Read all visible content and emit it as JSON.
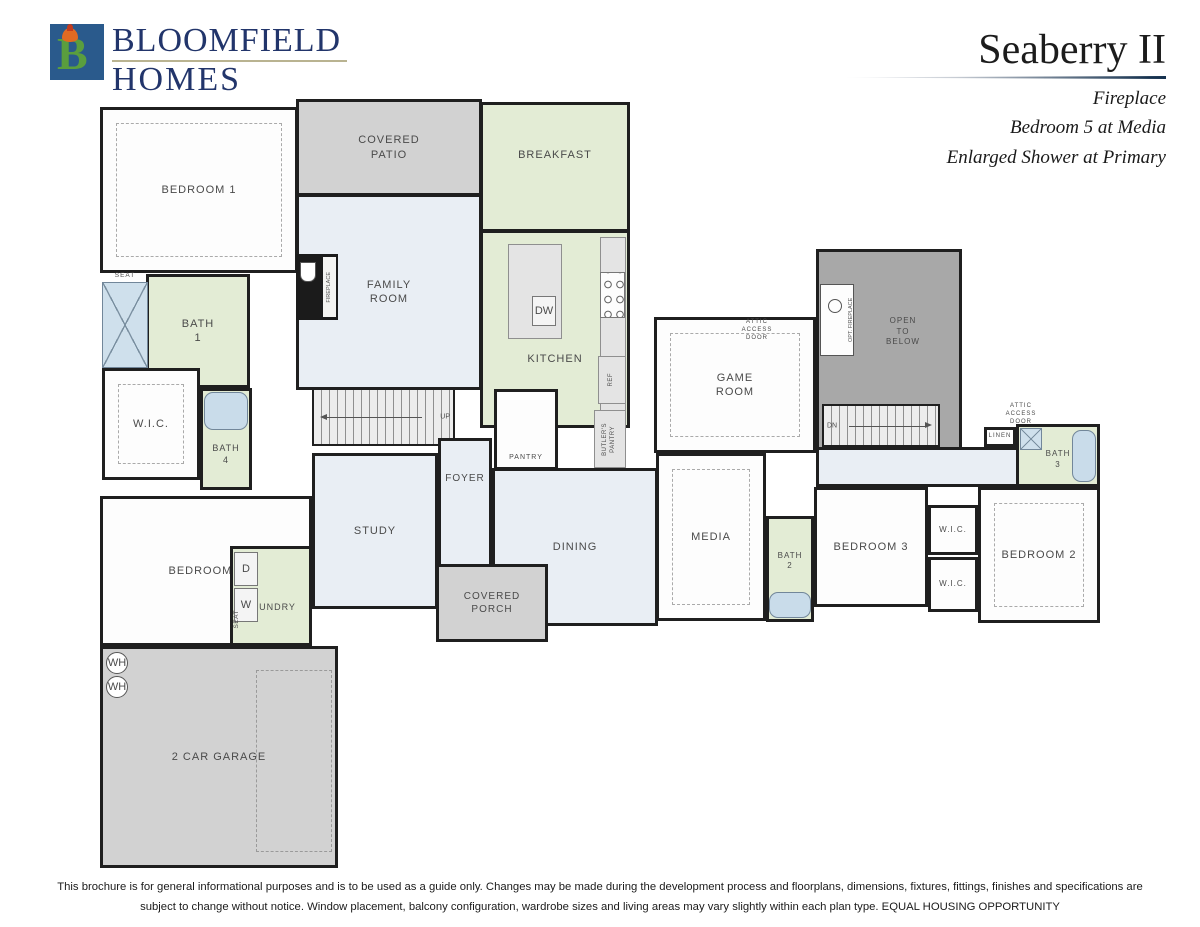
{
  "header": {
    "logo": {
      "monogram": "B",
      "line1": "BLOOMFIELD",
      "line2": "HOMES"
    },
    "plan_name": "Seaberry II",
    "options": [
      "Fireplace",
      "Bedroom 5 at Media",
      "Enlarged Shower at Primary"
    ]
  },
  "footer": {
    "line1": "This brochure is for general informational purposes and is to be used as a guide only. Changes may be made during the development process and floorplans, dimensions, fixtures, fittings, finishes and specifications are",
    "line2": "subject to change without notice. Window placement, balcony configuration, wardrobe sizes and living areas may vary slightly within each plan type.  EQUAL HOUSING OPPORTUNITY"
  },
  "colors": {
    "white": "#fdfdfd",
    "green": "#e3ecd5",
    "blue": "#e9eef4",
    "patio": "#d2d2d2",
    "garage": "#d2d2d2",
    "open": "#a8a8a8",
    "counter": "#e4e4e4",
    "wall": "#1f1f1f",
    "logo_blue": "#2a5a8c",
    "logo_green": "#5a9e3e",
    "logo_navy": "#22356b",
    "tub_blue": "#c9dcea"
  },
  "floor_plans": [
    {
      "name": "first-floor",
      "elements": [
        {
          "type": "room",
          "name": "bedroom-1",
          "label": "BEDROOM 1",
          "x": 100,
          "y": 107,
          "w": 198,
          "h": 166,
          "fill": "white",
          "dashedInner": true
        },
        {
          "type": "room",
          "name": "covered-patio",
          "label": "COVERED\nPATIO",
          "x": 296,
          "y": 99,
          "w": 186,
          "h": 97,
          "fill": "patio"
        },
        {
          "type": "room",
          "name": "breakfast",
          "label": "BREAKFAST",
          "x": 480,
          "y": 102,
          "w": 150,
          "h": 130,
          "fill": "green",
          "labelDy": -12
        },
        {
          "type": "room",
          "name": "family-room",
          "label": "FAMILY\nROOM",
          "x": 296,
          "y": 194,
          "w": 186,
          "h": 196,
          "fill": "blue"
        },
        {
          "type": "room",
          "name": "kitchen",
          "label": "KITCHEN",
          "x": 480,
          "y": 230,
          "w": 150,
          "h": 198,
          "fill": "green",
          "labelDy": 30
        },
        {
          "type": "counter",
          "name": "kitchen-counter",
          "x": 600,
          "y": 237,
          "w": 26,
          "h": 188
        },
        {
          "type": "cooktop",
          "name": "cooktop",
          "x": 600,
          "y": 272,
          "w": 25,
          "h": 46
        },
        {
          "type": "counter",
          "name": "kitchen-island",
          "x": 508,
          "y": 244,
          "w": 54,
          "h": 95
        },
        {
          "type": "appliance",
          "name": "dishwasher",
          "label": "DW",
          "x": 532,
          "y": 296,
          "w": 24,
          "h": 30
        },
        {
          "type": "fireplace",
          "name": "fireplace",
          "label": "FIREPLACE",
          "x": 296,
          "y": 254,
          "w": 42,
          "h": 66
        },
        {
          "type": "room",
          "name": "bath-1",
          "label": "BATH\n1",
          "x": 146,
          "y": 274,
          "w": 104,
          "h": 114,
          "fill": "green"
        },
        {
          "type": "fixture-shower",
          "name": "shower-bath-1",
          "x": 102,
          "y": 282,
          "w": 46,
          "h": 86
        },
        {
          "type": "label",
          "name": "seat-label-bath-1",
          "label": "SEAT",
          "x": 102,
          "y": 271,
          "w": 46,
          "h": 10,
          "fontSize": 6.5
        },
        {
          "type": "room",
          "name": "wic-primary",
          "label": "W.I.C.",
          "x": 102,
          "y": 368,
          "w": 98,
          "h": 112,
          "fill": "white",
          "dashedInner": true
        },
        {
          "type": "room",
          "name": "bath-4",
          "label": "BATH\n4",
          "x": 200,
          "y": 388,
          "w": 52,
          "h": 102,
          "fill": "green",
          "labelDy": 16,
          "fontSize": 9
        },
        {
          "type": "fixture-tub",
          "name": "tub-bath-4",
          "x": 204,
          "y": 392,
          "w": 44,
          "h": 38
        },
        {
          "type": "room",
          "name": "bedroom-5",
          "label": "BEDROOM 5",
          "x": 100,
          "y": 496,
          "w": 212,
          "h": 150,
          "fill": "white"
        },
        {
          "type": "room",
          "name": "laundry",
          "label": "LAUNDRY",
          "x": 230,
          "y": 546,
          "w": 82,
          "h": 100,
          "fill": "green",
          "labelDy": 12,
          "fontSize": 9
        },
        {
          "type": "appliance",
          "name": "dryer",
          "label": "D",
          "x": 234,
          "y": 552,
          "w": 24,
          "h": 34
        },
        {
          "type": "appliance",
          "name": "washer",
          "label": "W",
          "x": 234,
          "y": 588,
          "w": 24,
          "h": 34
        },
        {
          "type": "label",
          "name": "seat-label-laundry",
          "label": "SEAT",
          "x": 230,
          "y": 598,
          "w": 14,
          "h": 42,
          "fontSize": 6.5,
          "vertical": true
        },
        {
          "type": "stairs",
          "name": "stairs-up",
          "label": "UP",
          "x": 312,
          "y": 388,
          "w": 143,
          "h": 58,
          "dir": "left"
        },
        {
          "type": "room",
          "name": "study",
          "label": "STUDY",
          "x": 312,
          "y": 453,
          "w": 126,
          "h": 156,
          "fill": "blue"
        },
        {
          "type": "room",
          "name": "foyer",
          "label": "FOYER",
          "x": 438,
          "y": 438,
          "w": 54,
          "h": 152,
          "fill": "blue",
          "fontSize": 10,
          "labelDy": -36
        },
        {
          "type": "room",
          "name": "pantry",
          "label": "PANTRY",
          "x": 494,
          "y": 389,
          "w": 64,
          "h": 81,
          "fill": "white",
          "fontSize": 7,
          "labelDy": 28
        },
        {
          "type": "counter",
          "name": "ref-counter",
          "x": 598,
          "y": 356,
          "w": 28,
          "h": 48
        },
        {
          "type": "label",
          "name": "ref-label",
          "label": "REF",
          "x": 600,
          "y": 358,
          "w": 24,
          "h": 44,
          "fontSize": 6,
          "vertical": true
        },
        {
          "type": "counter",
          "name": "butlers-pantry-counter",
          "x": 594,
          "y": 410,
          "w": 32,
          "h": 58
        },
        {
          "type": "label",
          "name": "butlers-pantry-label",
          "label": "BUTLER'S\nPANTRY",
          "x": 596,
          "y": 412,
          "w": 28,
          "h": 54,
          "fontSize": 6,
          "vertical": true
        },
        {
          "type": "room",
          "name": "dining",
          "label": "DINING",
          "x": 492,
          "y": 468,
          "w": 166,
          "h": 158,
          "fill": "blue"
        },
        {
          "type": "room",
          "name": "covered-porch",
          "label": "COVERED\nPORCH",
          "x": 436,
          "y": 564,
          "w": 112,
          "h": 78,
          "fill": "patio",
          "fontSize": 10
        },
        {
          "type": "room",
          "name": "garage",
          "label": "2 CAR GARAGE",
          "x": 100,
          "y": 646,
          "w": 238,
          "h": 222,
          "fill": "garage"
        },
        {
          "type": "dashed",
          "name": "garage-bay-outline",
          "x": 256,
          "y": 670,
          "w": 76,
          "h": 182
        },
        {
          "type": "circle",
          "name": "water-heater-1",
          "label": "WH",
          "x": 106,
          "y": 652,
          "w": 22,
          "h": 22
        },
        {
          "type": "circle",
          "name": "water-heater-2",
          "label": "WH",
          "x": 106,
          "y": 676,
          "w": 22,
          "h": 22
        }
      ]
    },
    {
      "name": "second-floor",
      "elements": [
        {
          "type": "room",
          "name": "open-to-below",
          "label": "OPEN\nTO\nBELOW",
          "x": 816,
          "y": 249,
          "w": 146,
          "h": 206,
          "fill": "open",
          "fontSize": 8,
          "labelDy": -20,
          "labelDx": 14
        },
        {
          "type": "fireplace2",
          "name": "optional-fireplace",
          "label": "OPT. FIREPLACE",
          "x": 820,
          "y": 284,
          "w": 34,
          "h": 72
        },
        {
          "type": "room",
          "name": "game-room",
          "label": "GAME\nROOM",
          "x": 654,
          "y": 317,
          "w": 162,
          "h": 136,
          "fill": "white",
          "dashedInner": true
        },
        {
          "type": "label",
          "name": "attic-access-door-label-1",
          "label": "ATTIC\nACCESS\nDOOR",
          "x": 734,
          "y": 318,
          "w": 46,
          "h": 26,
          "fontSize": 6
        },
        {
          "type": "stairs",
          "name": "stairs-down",
          "label": "DN",
          "x": 822,
          "y": 404,
          "w": 118,
          "h": 43,
          "dir": "right"
        },
        {
          "type": "room",
          "name": "upstairs-hall",
          "label": "",
          "x": 816,
          "y": 447,
          "w": 216,
          "h": 40,
          "fill": "blue"
        },
        {
          "type": "label",
          "name": "attic-access-door-label-2",
          "label": "ATTIC\nACCESS\nDOOR",
          "x": 1000,
          "y": 402,
          "w": 42,
          "h": 26,
          "fontSize": 6
        },
        {
          "type": "room",
          "name": "linen",
          "label": "LINEN",
          "x": 984,
          "y": 427,
          "w": 32,
          "h": 20,
          "fill": "white",
          "fontSize": 6
        },
        {
          "type": "room",
          "name": "bath-3",
          "label": "BATH\n3",
          "x": 1016,
          "y": 424,
          "w": 84,
          "h": 63,
          "fill": "green",
          "fontSize": 8,
          "labelDy": 4
        },
        {
          "type": "fixture-shower",
          "name": "shower-bath-3",
          "x": 1020,
          "y": 428,
          "w": 22,
          "h": 22
        },
        {
          "type": "fixture-tub-v",
          "name": "tub-bath-3",
          "x": 1072,
          "y": 430,
          "w": 24,
          "h": 52
        },
        {
          "type": "room",
          "name": "media",
          "label": "MEDIA",
          "x": 656,
          "y": 453,
          "w": 110,
          "h": 168,
          "fill": "white",
          "dashedInner": true
        },
        {
          "type": "room",
          "name": "bath-2",
          "label": "BATH\n2",
          "x": 766,
          "y": 516,
          "w": 48,
          "h": 106,
          "fill": "green",
          "fontSize": 8,
          "labelDy": -8
        },
        {
          "type": "fixture-tub",
          "name": "tub-bath-2",
          "x": 769,
          "y": 592,
          "w": 42,
          "h": 26
        },
        {
          "type": "room",
          "name": "bedroom-3",
          "label": "BEDROOM 3",
          "x": 814,
          "y": 487,
          "w": 114,
          "h": 120,
          "fill": "white"
        },
        {
          "type": "room",
          "name": "wic-bedroom-3",
          "label": "W.I.C.",
          "x": 928,
          "y": 505,
          "w": 50,
          "h": 50,
          "fill": "white",
          "fontSize": 8
        },
        {
          "type": "room",
          "name": "wic-bedroom-2",
          "label": "W.I.C.",
          "x": 928,
          "y": 557,
          "w": 50,
          "h": 55,
          "fill": "white",
          "fontSize": 8
        },
        {
          "type": "room",
          "name": "bedroom-2",
          "label": "BEDROOM 2",
          "x": 978,
          "y": 487,
          "w": 122,
          "h": 136,
          "fill": "white",
          "dashedInner": true
        }
      ]
    }
  ]
}
